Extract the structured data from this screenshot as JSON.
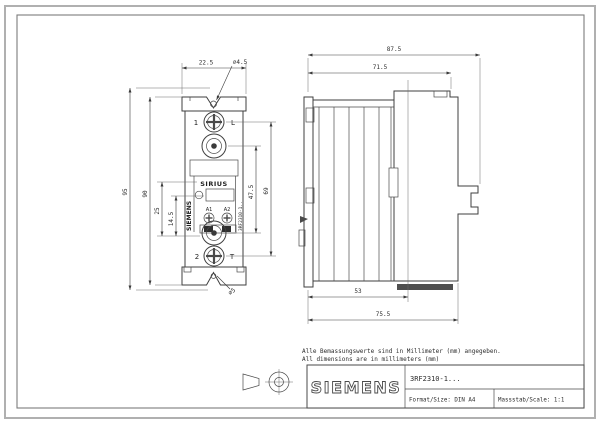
{
  "notes": {
    "de": "Alle Bemassungswerte sind in Millimeter (mm) angegeben.",
    "en": "All dimensions are in millimeters (mm)"
  },
  "title_block": {
    "brand": "SIEMENS",
    "part_number": "3RF2310-1...",
    "format": "Format/Size: DIN A4",
    "scale": "Massstab/Scale: 1:1"
  },
  "front_view": {
    "dims": {
      "width_top": "22.5",
      "hole_top": "⌀4.5",
      "height_outer": "95",
      "height_body": "90",
      "led_offset": "25",
      "coil_offset": "14.5",
      "terminal_pitch": "47.5",
      "screw_pitch": "69",
      "hole_bottom": "⌀5"
    },
    "labels": {
      "terminal_1": "1",
      "mark_l": "L",
      "terminal_2": "2",
      "mark_t": "T",
      "product": "SIRIUS",
      "brand_vertical": "SIEMENS",
      "part_vertical": "3RF2310-1..",
      "coil_a1": "A1",
      "coil_a2": "A2"
    }
  },
  "side_view": {
    "dims": {
      "total_depth": "87.5",
      "body_depth": "71.5",
      "heatsink_depth": "53",
      "din_depth": "75.5"
    }
  },
  "colors": {
    "line": "#4a4a4a",
    "dim": "#3a3a3a",
    "frame_outer": "#b0b0b0",
    "frame_inner": "#777777",
    "dark_fill": "#2e2e2e",
    "paper": "#ffffff"
  }
}
